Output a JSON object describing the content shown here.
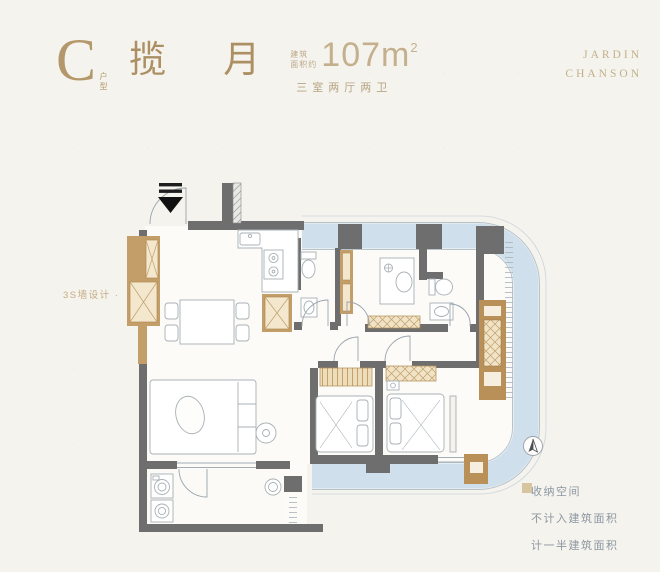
{
  "header": {
    "unit_letter": "C",
    "unit_type_label": "户型",
    "unit_name": "揽 月",
    "area_note_line1": "建筑",
    "area_note_line2": "面积约",
    "area_value": "107",
    "area_unit": "m",
    "area_exponent": "2",
    "rooms_desc": "三室两厅两卫",
    "brand_line1": "JARDIN",
    "brand_line2": "CHANSON"
  },
  "plan": {
    "wall_annotation": "3S墙设计 ·"
  },
  "legend": {
    "items": [
      {
        "label": "收纳空间",
        "color": "#c4a06a"
      },
      {
        "label": "不计入建筑面积",
        "color": "#c9dcea"
      },
      {
        "label": "计一半建筑面积",
        "color": "#d7c5a2"
      }
    ]
  },
  "colors": {
    "background": "#f5f3ee",
    "title_gold": "#b4986b",
    "brand_gold": "#c2b088",
    "wall_gray": "#6e6e6e",
    "storage_tan": "#c09a66",
    "storage_panel": "#f3e7cd",
    "balcony_blue": "#cfe0ec",
    "line_gray": "#9aa4ab"
  }
}
